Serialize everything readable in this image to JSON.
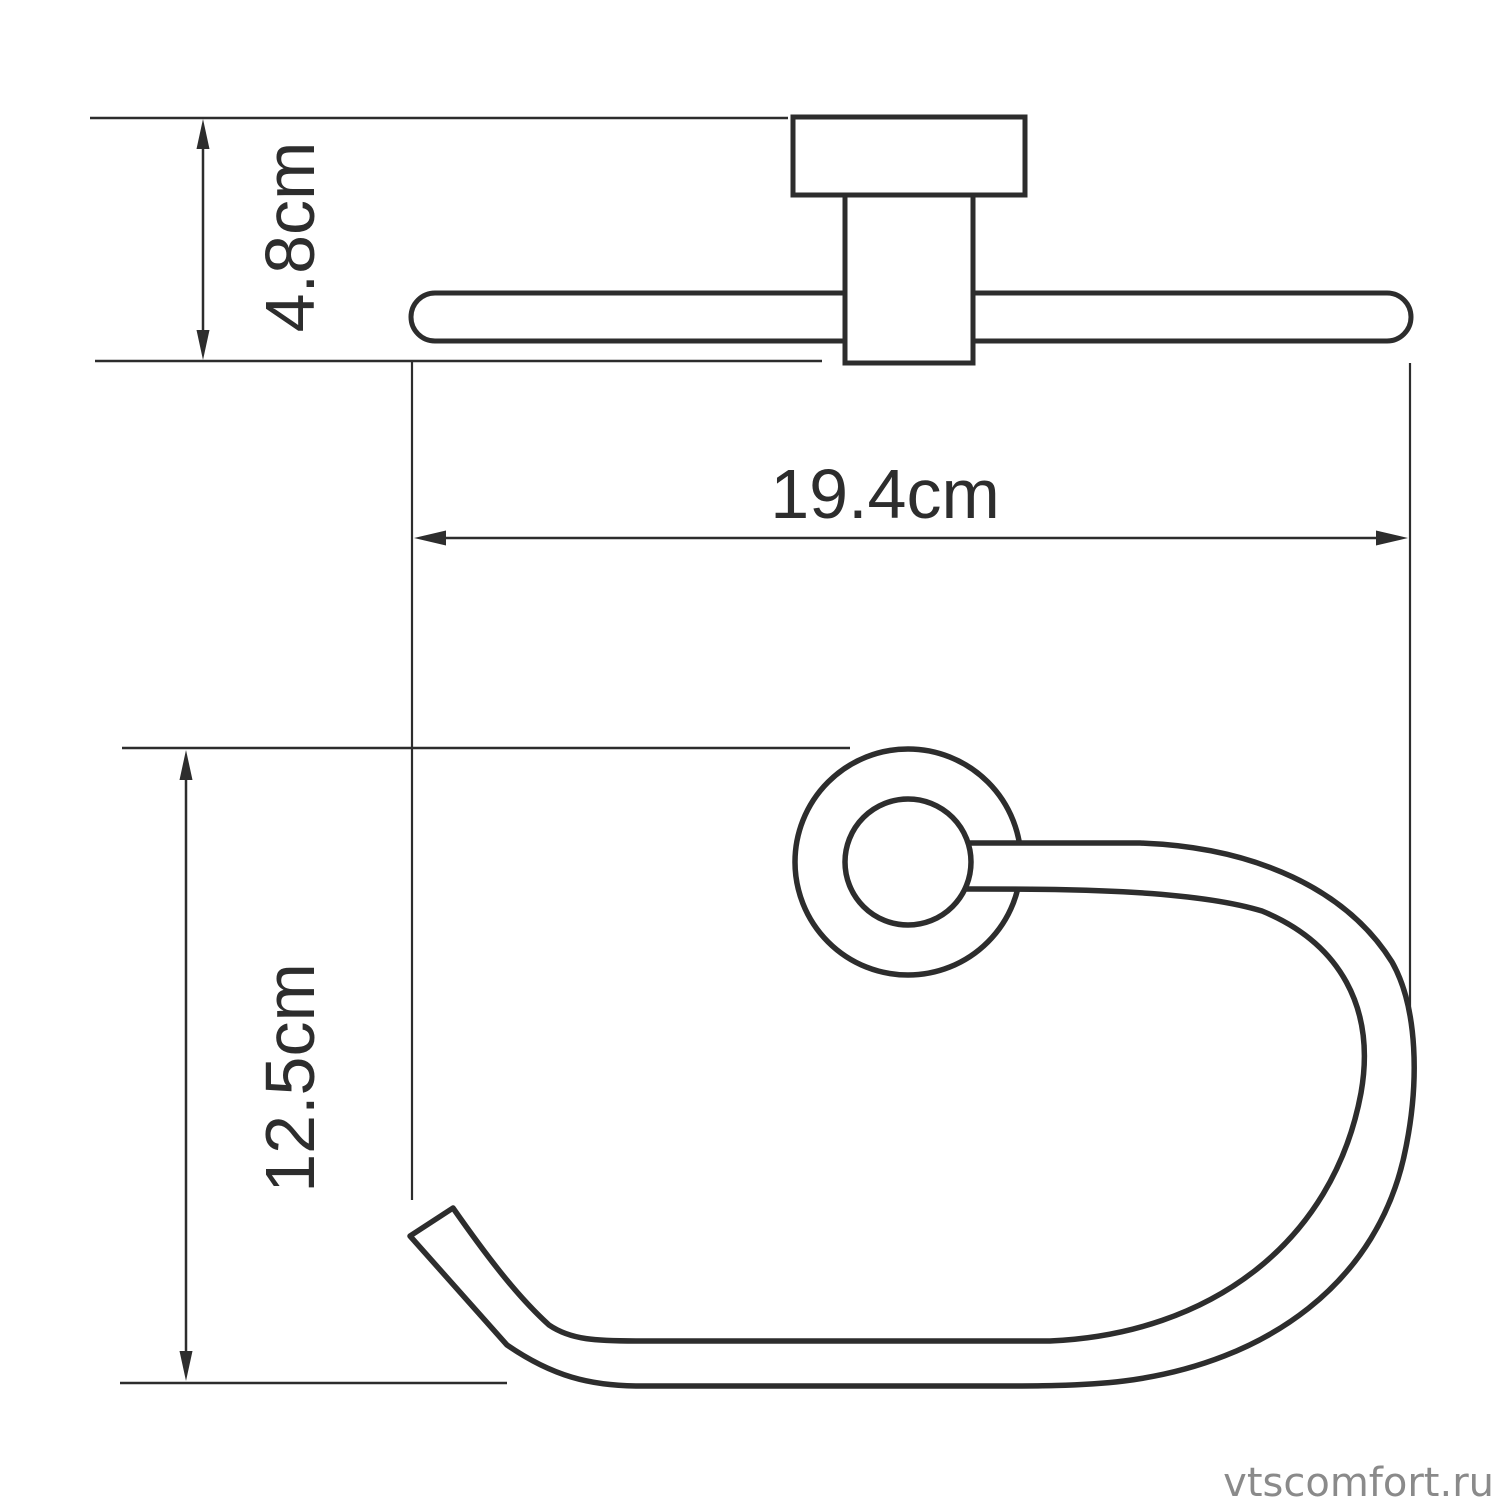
{
  "page": {
    "background": "#ffffff"
  },
  "drawing": {
    "stroke_color": "#2d2d2d",
    "fill_color": "#ffffff",
    "top_view": {
      "parts": [
        "wall-plate",
        "mount-post",
        "towel-bar"
      ]
    },
    "front_view": {
      "parts": [
        "rosette-outer-circle",
        "rosette-inner-circle",
        "towel-hook-ring"
      ]
    },
    "dimensions": [
      {
        "id": "mount_depth",
        "label": "4.8cm",
        "value_cm": 4.8,
        "orientation": "vertical"
      },
      {
        "id": "overall_width",
        "label": "19.4cm",
        "value_cm": 19.4,
        "orientation": "horizontal"
      },
      {
        "id": "ring_height",
        "label": "12.5cm",
        "value_cm": 12.5,
        "orientation": "vertical"
      }
    ]
  },
  "watermark": {
    "text": "vtscomfort.ru",
    "color": "#8a8a8a"
  }
}
